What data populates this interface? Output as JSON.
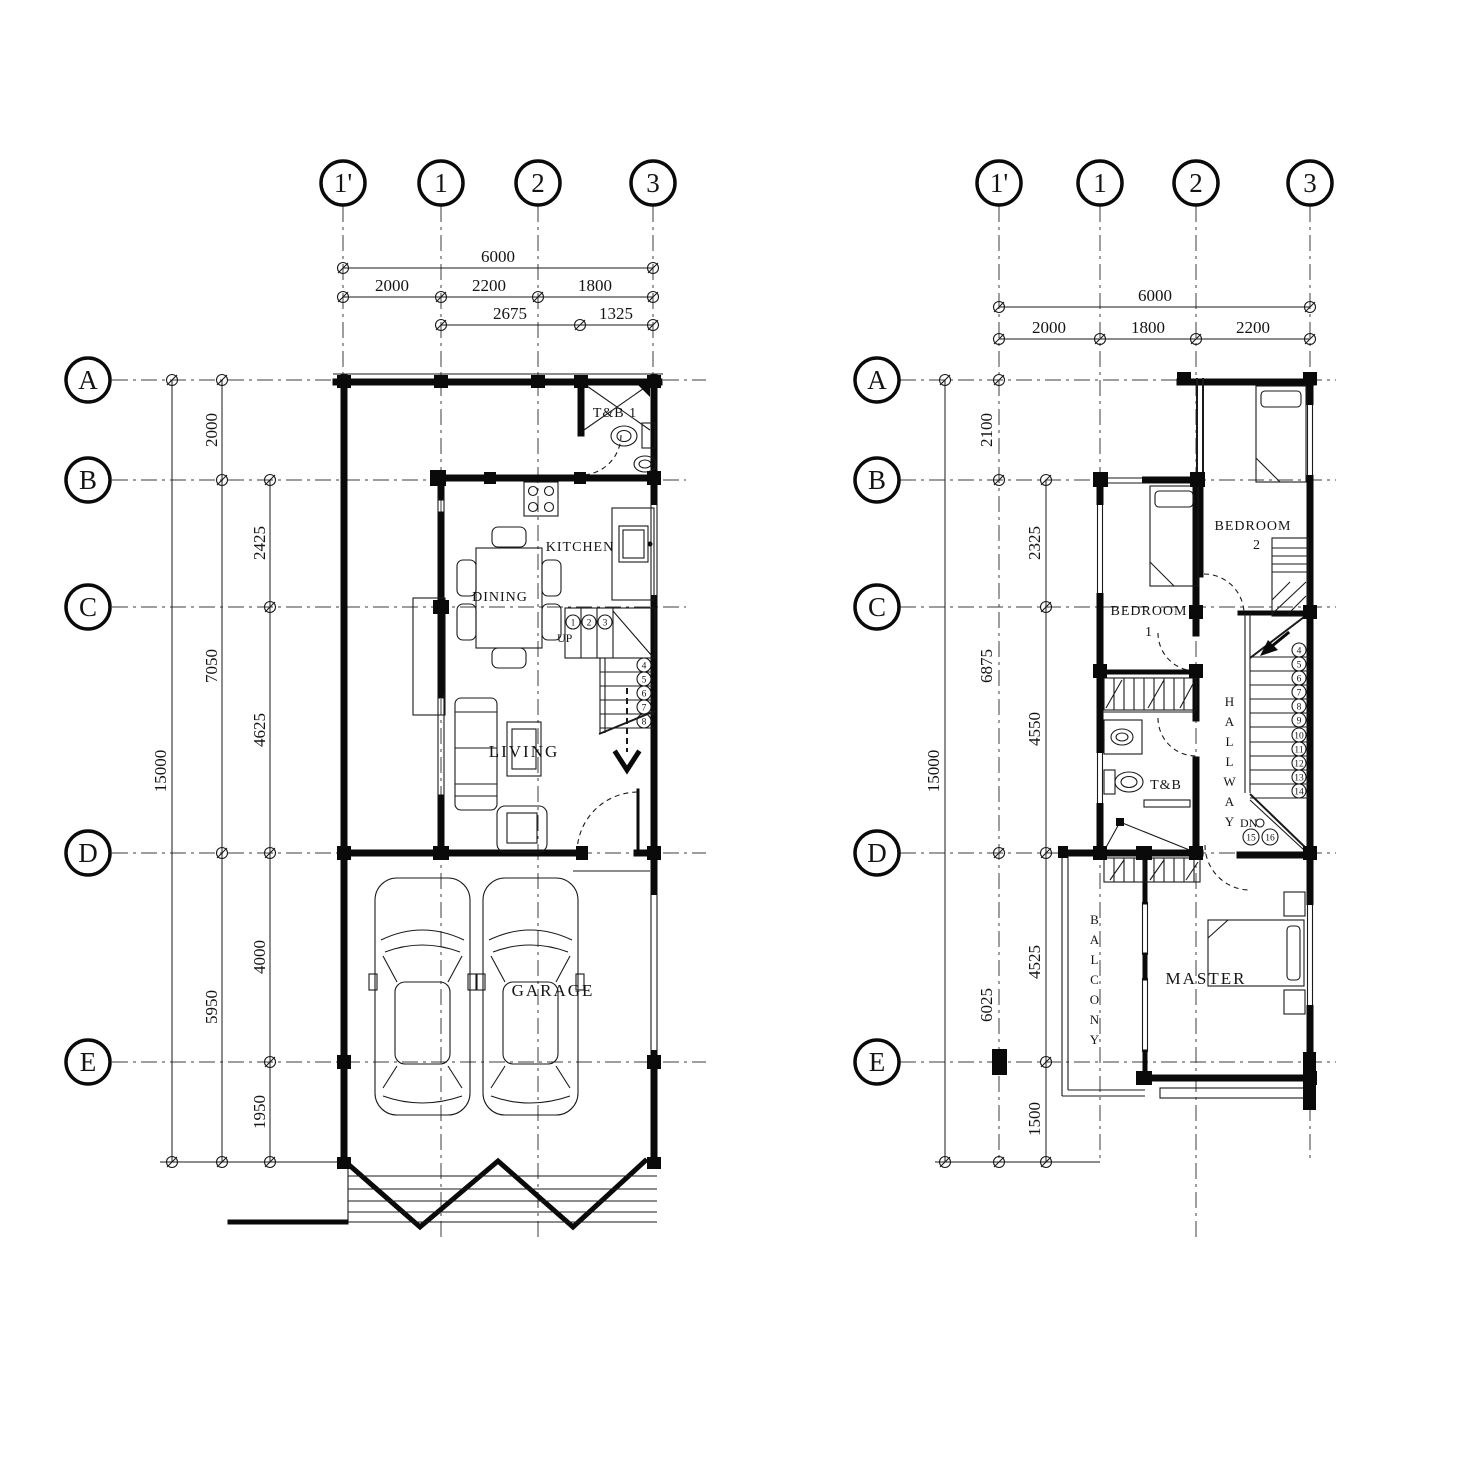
{
  "sheet": {
    "bg": "#ffffff",
    "ink": "#141414"
  },
  "ground_floor": {
    "grid": {
      "columns": [
        "1'",
        "1",
        "2",
        "3"
      ],
      "rows": [
        "A",
        "B",
        "C",
        "D",
        "E"
      ]
    },
    "dims": {
      "width_total": "6000",
      "width_segments": [
        "2000",
        "2200",
        "1800"
      ],
      "width_sub_segments": [
        "2675",
        "1325"
      ],
      "height_total": "15000",
      "height_outer_segments": [
        "2000",
        "7050",
        "5950"
      ],
      "height_inner_segments": [
        "2425",
        "4625",
        "4000",
        "1950"
      ]
    },
    "rooms": {
      "tb1": "T&B 1",
      "kitchen": "KITCHEN",
      "dining": "DINING",
      "living": "LIVING",
      "garage": "GARAGE"
    },
    "stairs": {
      "direction_label": "UP",
      "step_numbers": [
        "1",
        "2",
        "3",
        "4",
        "5",
        "6",
        "7",
        "8"
      ]
    }
  },
  "second_floor": {
    "grid": {
      "columns": [
        "1'",
        "1",
        "2",
        "3"
      ],
      "rows": [
        "A",
        "B",
        "C",
        "D",
        "E"
      ]
    },
    "dims": {
      "width_total": "6000",
      "width_segments": [
        "2000",
        "1800",
        "2200"
      ],
      "height_total": "15000",
      "height_outer_segments": [
        "2100",
        "6875",
        "6025"
      ],
      "height_inner_segments": [
        "2325",
        "4550",
        "4525",
        "1500"
      ]
    },
    "rooms": {
      "bedroom2_line1": "BEDROOM",
      "bedroom2_line2": "2",
      "bedroom1_line1": "BEDROOM",
      "bedroom1_line2": "1",
      "hallway": "HALLWAY",
      "tb": "T&B",
      "master": "MASTER",
      "balcony": "BALCONY"
    },
    "stairs": {
      "direction_label": "DN",
      "step_numbers": [
        "4",
        "5",
        "6",
        "7",
        "8",
        "9",
        "10",
        "11",
        "12",
        "13",
        "14",
        "15",
        "16"
      ]
    }
  }
}
